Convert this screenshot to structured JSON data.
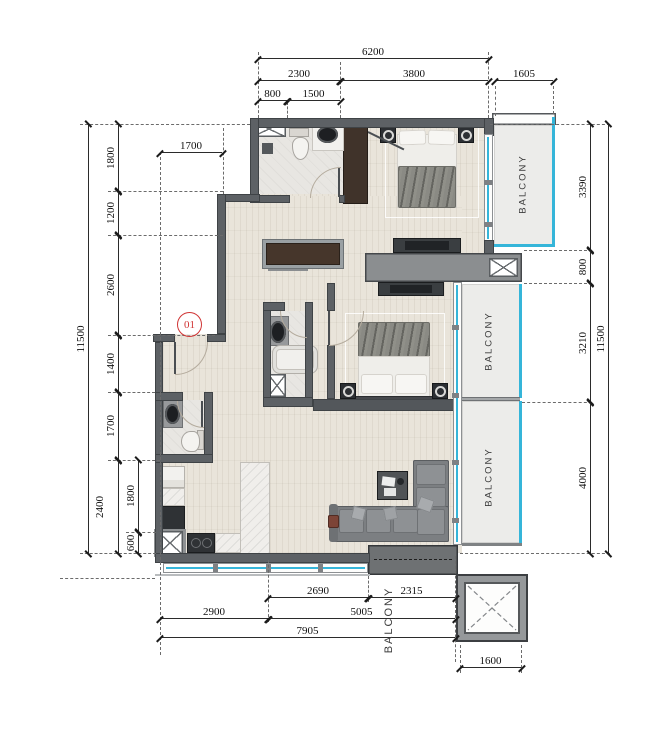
{
  "unit": {
    "label": "01"
  },
  "labels": {
    "balcony_top_right": "BALCONY",
    "balcony_mid_right": "BALCONY",
    "balcony_low_right": "BALCONY",
    "balcony_bottom": "BALCONY"
  },
  "dimensions": {
    "top_overall": "6200",
    "top_2300": "2300",
    "top_3800": "3800",
    "top_1605": "1605",
    "top_800": "800",
    "top_1500": "1500",
    "corridor_1700": "1700",
    "left_overall": "11500",
    "left_1800": "1800",
    "left_1200": "1200",
    "left_2600": "2600",
    "left_1400": "1400",
    "left_1700": "1700",
    "left_2400": "2400",
    "left_inner_1800": "1800",
    "left_inner_600": "600",
    "right_3390": "3390",
    "right_800": "800",
    "right_3210": "3210",
    "right_4000": "4000",
    "right_overall": "11500",
    "bottom_2690": "2690",
    "bottom_2315": "2315",
    "bottom_2900": "2900",
    "bottom_5005": "5005",
    "bottom_7905": "7905",
    "shaft_1600": "1600"
  },
  "colors": {
    "glass_cyan": "#35b5d9",
    "wall_gray": "#5d6165",
    "unit_red": "#d03434",
    "dim_text": "#101010"
  }
}
